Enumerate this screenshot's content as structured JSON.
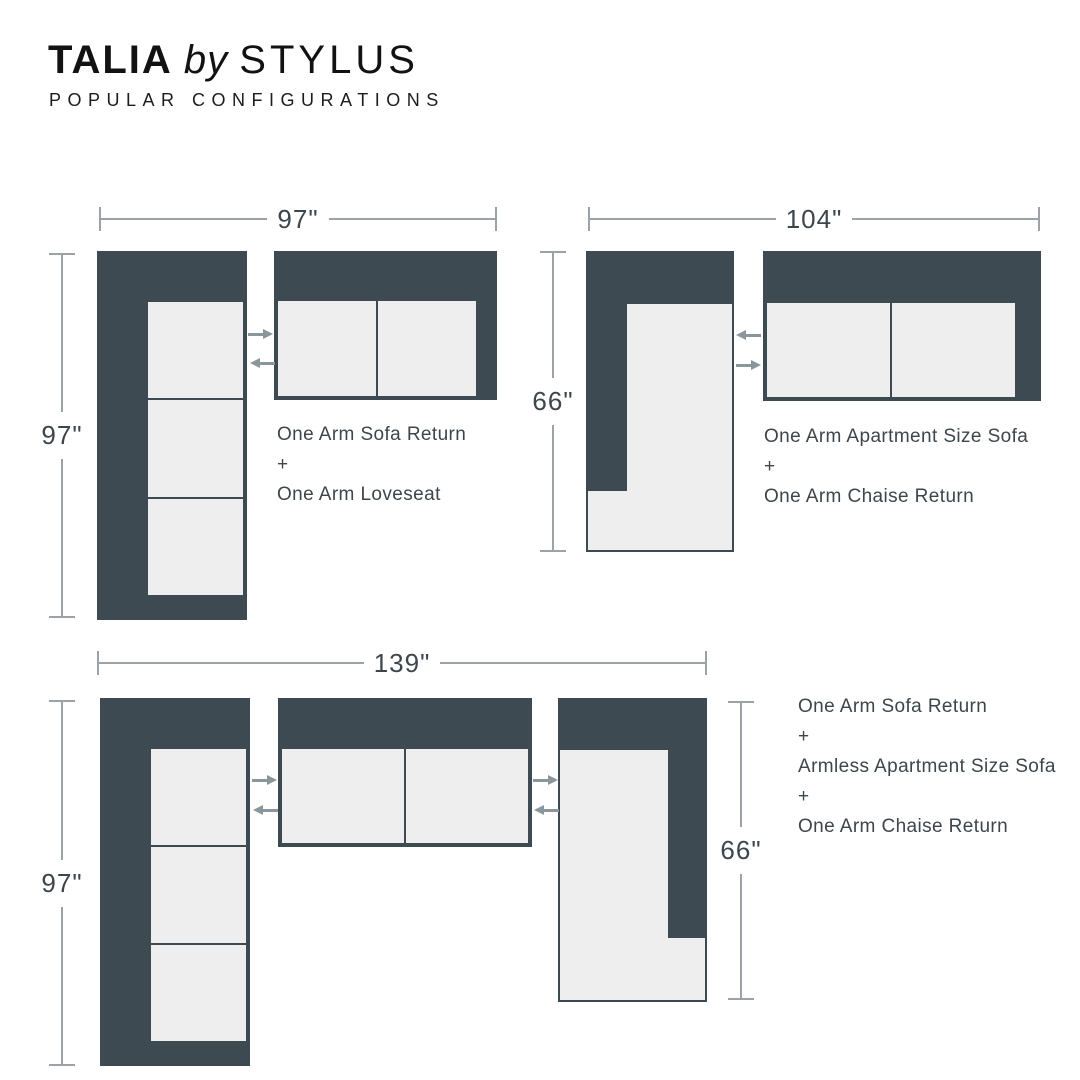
{
  "header": {
    "brand": "TALIA",
    "connector": "by",
    "maker": "STYLUS",
    "subtitle": "POPULAR CONFIGURATIONS"
  },
  "configurations": [
    {
      "name": "97 x 97 sectional",
      "width_label": "97\"",
      "height_label": "97\"",
      "lines": [
        "One Arm Sofa Return",
        "+",
        "One Arm Loveseat"
      ]
    },
    {
      "name": "104 x 66 sectional",
      "width_label": "104\"",
      "height_label": "66\"",
      "lines": [
        "One Arm Apartment Size Sofa",
        "+",
        "One Arm Chaise Return"
      ]
    },
    {
      "name": "139 x 97 sectional",
      "width_label": "139\"",
      "height_label_left": "97\"",
      "height_label_right": "66\"",
      "lines": [
        "One Arm Sofa Return",
        "+",
        "Armless Apartment Size Sofa",
        "+",
        "One Arm Chaise Return"
      ]
    }
  ],
  "colors": {
    "dark": "#3E4A51",
    "cushion": "#EDEEED",
    "dimension_line": "#9BA3A9",
    "arrow": "#8B969C",
    "text": "#3D464D",
    "title": "#121212"
  }
}
